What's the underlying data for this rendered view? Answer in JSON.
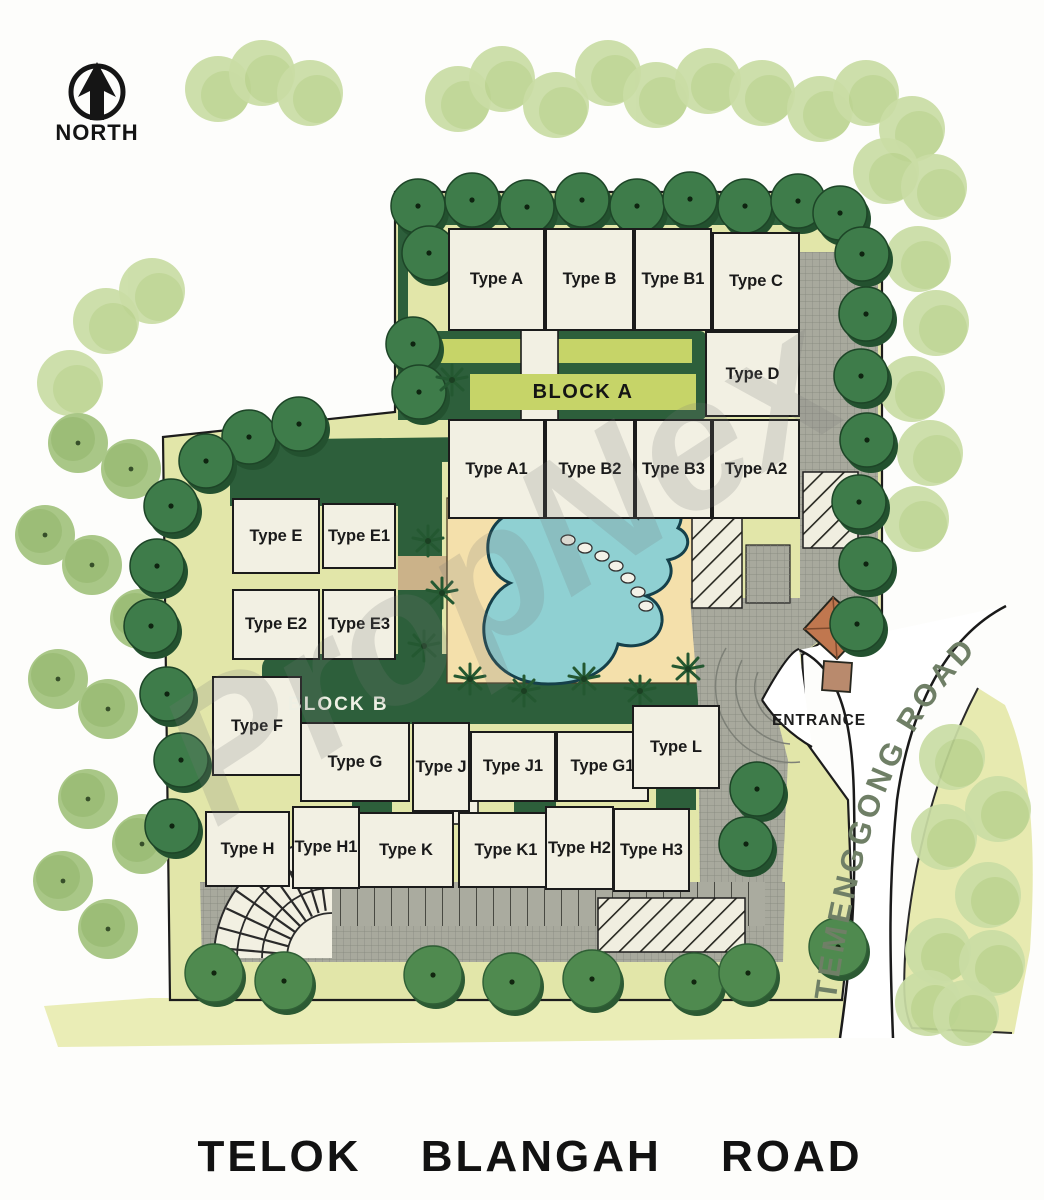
{
  "north_label": "NORTH",
  "watermark": {
    "text": "PropNex"
  },
  "blocks": {
    "block_a": "BLOCK A",
    "block_b": "BLOCK B"
  },
  "entrance_label": "ENTRANCE",
  "roads": {
    "temenggong": "TEMENGGONG ROAD",
    "telok_blangah": "TELOK BLANGAH ROAD"
  },
  "units": {
    "block_a_row1": [
      "Type A",
      "Type B",
      "Type B1",
      "Type C"
    ],
    "block_a_type_d": "Type D",
    "block_a_row2": [
      "Type A1",
      "Type B2",
      "Type B3",
      "Type A2"
    ],
    "block_e": [
      "Type E",
      "Type E1",
      "Type E2",
      "Type E3"
    ],
    "block_b_row1": [
      "Type F",
      "Type G",
      "Type J",
      "Type J1",
      "Type G1",
      "Type L"
    ],
    "block_b_row2": [
      "Type H",
      "Type H1",
      "Type K",
      "Type K1",
      "Type H2",
      "Type H3"
    ]
  },
  "colors": {
    "grass": "#e2e6a9",
    "hedge": "#2d5f3b",
    "pool_water": "#8fd0d2",
    "pool_deck": "#f4e0ab",
    "pavement": "#a8a99d",
    "guardhouse_roof": "#c0774f",
    "road_label_green": "#6f7f66"
  }
}
